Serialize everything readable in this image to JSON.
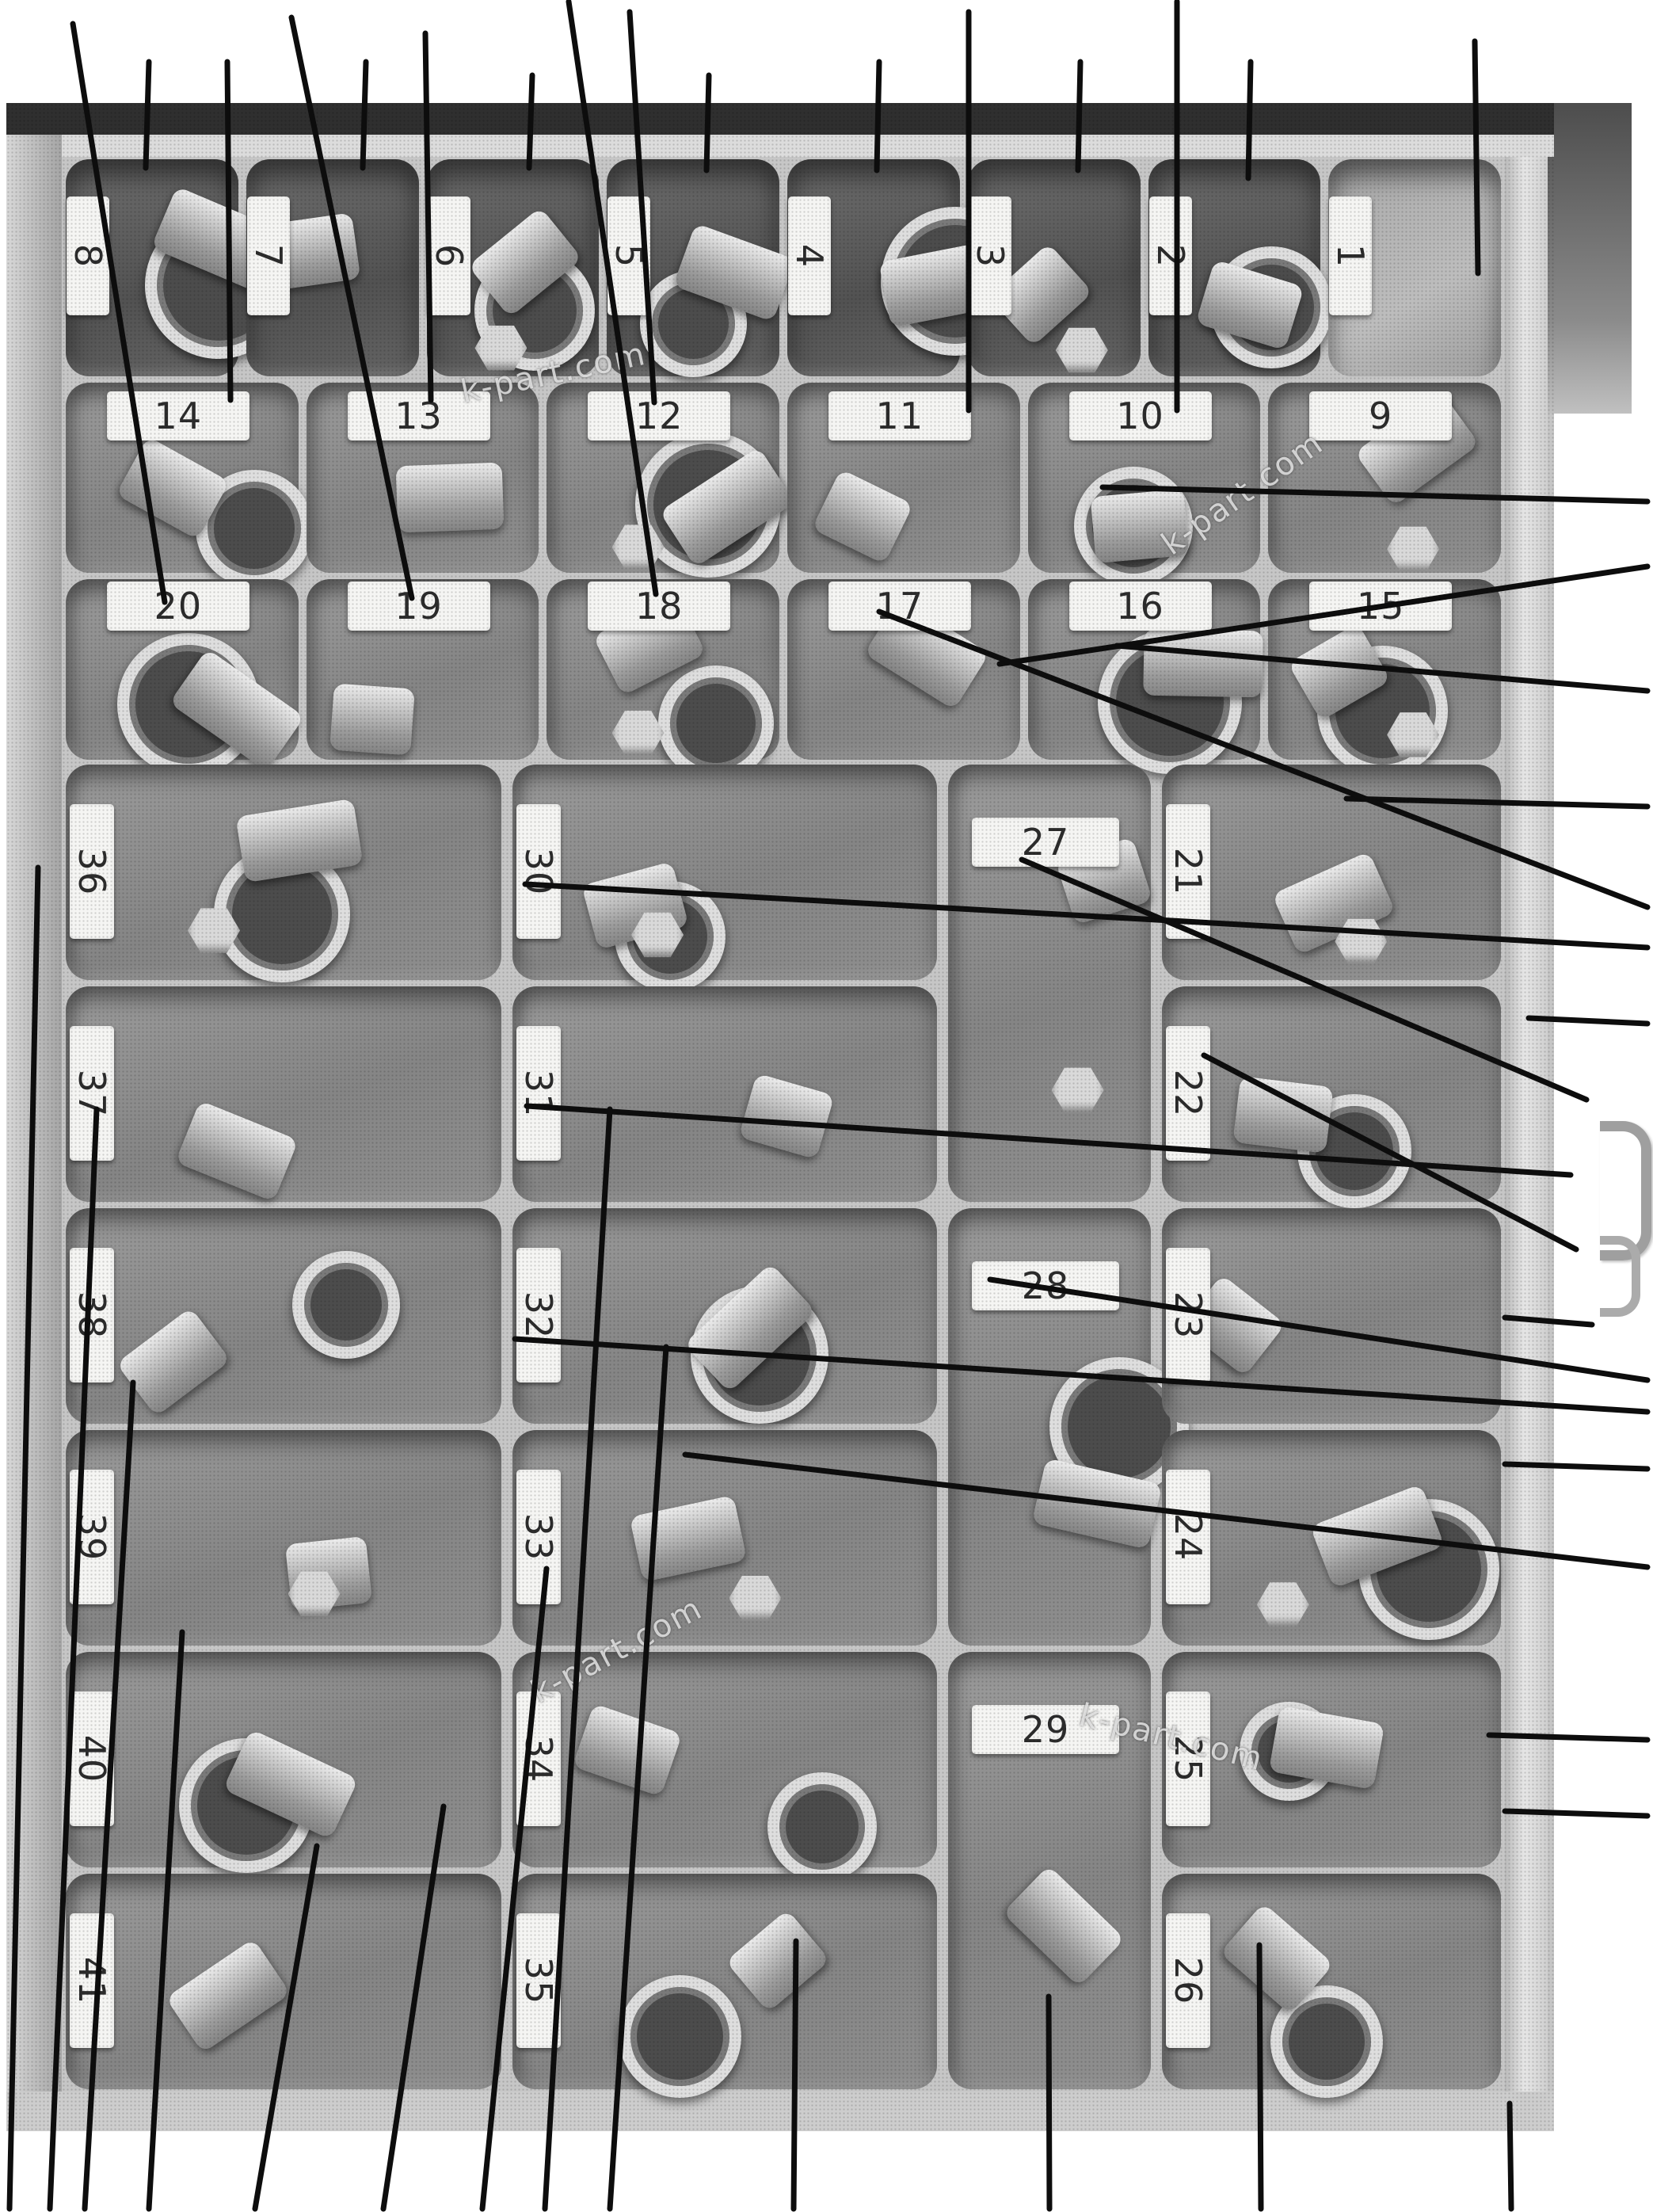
{
  "watermark": {
    "text": "k-part.com"
  },
  "tray": {
    "top_row_labels": [
      "8",
      "7",
      "6",
      "5",
      "4",
      "3",
      "2",
      "1"
    ],
    "second_row_labels": [
      "14",
      "13",
      "12",
      "11",
      "10",
      "9"
    ],
    "third_row_labels": [
      "20",
      "19",
      "18",
      "17",
      "16",
      "15"
    ],
    "left_column_labels": [
      "36",
      "37",
      "38",
      "39",
      "40",
      "41"
    ],
    "mid_left_column_labels": [
      "30",
      "31",
      "32",
      "33",
      "34",
      "35"
    ],
    "mid_right_column_labels": [
      "27",
      "28",
      "29"
    ],
    "right_column_labels": [
      "21",
      "22",
      "23",
      "24",
      "25",
      "26"
    ]
  },
  "colors": {
    "callout_line": "#0d0d0d",
    "tray_divider": "#c6c6c6",
    "bin_fill": "#8d8d8d",
    "tag_fill": "#f5f5f3",
    "tag_text": "#2c2c2c",
    "top_band": "#2f2f2f"
  },
  "callouts": [
    [
      188,
      78,
      184,
      212
    ],
    [
      287,
      78,
      291,
      505
    ],
    [
      462,
      78,
      458,
      212
    ],
    [
      537,
      42,
      544,
      505
    ],
    [
      672,
      95,
      668,
      212
    ],
    [
      795,
      15,
      826,
      508
    ],
    [
      895,
      95,
      892,
      215
    ],
    [
      1110,
      78,
      1107,
      215
    ],
    [
      1223,
      15,
      1223,
      518
    ],
    [
      1364,
      78,
      1361,
      215
    ],
    [
      1486,
      2,
      1486,
      518
    ],
    [
      1579,
      78,
      1576,
      225
    ],
    [
      1862,
      52,
      1866,
      345
    ],
    [
      92,
      30,
      208,
      760
    ],
    [
      368,
      22,
      520,
      755
    ],
    [
      718,
      2,
      828,
      750
    ],
    [
      1392,
      615,
      2080,
      633
    ],
    [
      1262,
      838,
      2080,
      715
    ],
    [
      1410,
      815,
      2080,
      872
    ],
    [
      1700,
      1008,
      2080,
      1018
    ],
    [
      663,
      1116,
      2080,
      1196
    ],
    [
      1290,
      1085,
      2003,
      1388
    ],
    [
      1110,
      772,
      2080,
      1145
    ],
    [
      1930,
      1285,
      2080,
      1292
    ],
    [
      665,
      1396,
      1983,
      1483
    ],
    [
      1520,
      1332,
      1990,
      1577
    ],
    [
      650,
      1690,
      2080,
      1782
    ],
    [
      1250,
      1615,
      2080,
      1742
    ],
    [
      1900,
      1663,
      2010,
      1672
    ],
    [
      865,
      1836,
      2080,
      1978
    ],
    [
      1900,
      1848,
      2080,
      1854
    ],
    [
      1880,
      2190,
      2080,
      2196
    ],
    [
      1900,
      2286,
      2080,
      2292
    ],
    [
      48,
      1095,
      12,
      2788
    ],
    [
      122,
      1400,
      63,
      2788
    ],
    [
      168,
      1745,
      107,
      2788
    ],
    [
      230,
      2060,
      188,
      2788
    ],
    [
      400,
      2330,
      322,
      2788
    ],
    [
      560,
      2280,
      484,
      2788
    ],
    [
      690,
      1980,
      609,
      2788
    ],
    [
      841,
      1700,
      770,
      2788
    ],
    [
      1005,
      2450,
      1002,
      2788
    ],
    [
      770,
      1400,
      688,
      2788
    ],
    [
      1324,
      2520,
      1325,
      2788
    ],
    [
      1590,
      2455,
      1592,
      2788
    ],
    [
      1906,
      2655,
      1908,
      2788
    ]
  ]
}
